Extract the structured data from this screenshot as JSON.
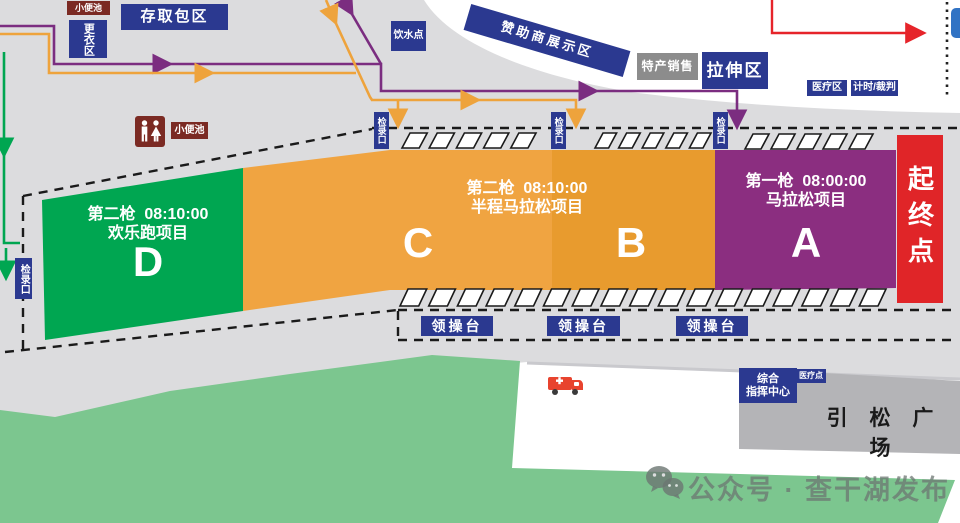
{
  "map_title": "马拉松起终点区域平面图",
  "colors": {
    "background": "#DCDCDE",
    "zone_d_green": "#00A651",
    "zone_c_orange": "#F0A441",
    "zone_b_orange": "#E89B2E",
    "zone_a_purple": "#8B2E80",
    "start_finish_red": "#E02528",
    "label_blue": "#2B3990",
    "label_gray": "#8C8C8C",
    "label_darkred": "#7B2A23",
    "route_purple": "#7B2D80",
    "route_orange": "#EEA33C",
    "route_green": "#00A651",
    "route_red": "#E6242A",
    "field_green": "#7CC68F",
    "plaza_gray": "#B4B4B7"
  },
  "facilities": {
    "urinal": "小便池",
    "changing_room": "更衣区",
    "bag_storage": "存取包区",
    "water_point": "饮水点",
    "sponsor_display": "赞助商展示区",
    "specialty_sales": "特产销售",
    "stretching_area": "拉伸区",
    "medical_area": "医疗区",
    "timing_referee": "计时/裁判",
    "checkin_gate": "检录口",
    "stage_platform": "领操台",
    "command_center_line1": "综合",
    "command_center_line2": "指挥中心",
    "medical_point": "医疗点",
    "plaza": "引 松 广 场",
    "start_finish": "起终点"
  },
  "zones": {
    "d": {
      "line1": "第二枪  08:10:00",
      "line2": "欢乐跑项目",
      "letter": "D"
    },
    "cb": {
      "line1": "第二枪  08:10:00",
      "line2": "半程马拉松项目",
      "letter_c": "C",
      "letter_b": "B"
    },
    "a": {
      "line1": "第一枪  08:00:00",
      "line2": "马拉松项目",
      "letter": "A"
    }
  },
  "watermark": {
    "text": "公众号 · 查干湖发布"
  }
}
